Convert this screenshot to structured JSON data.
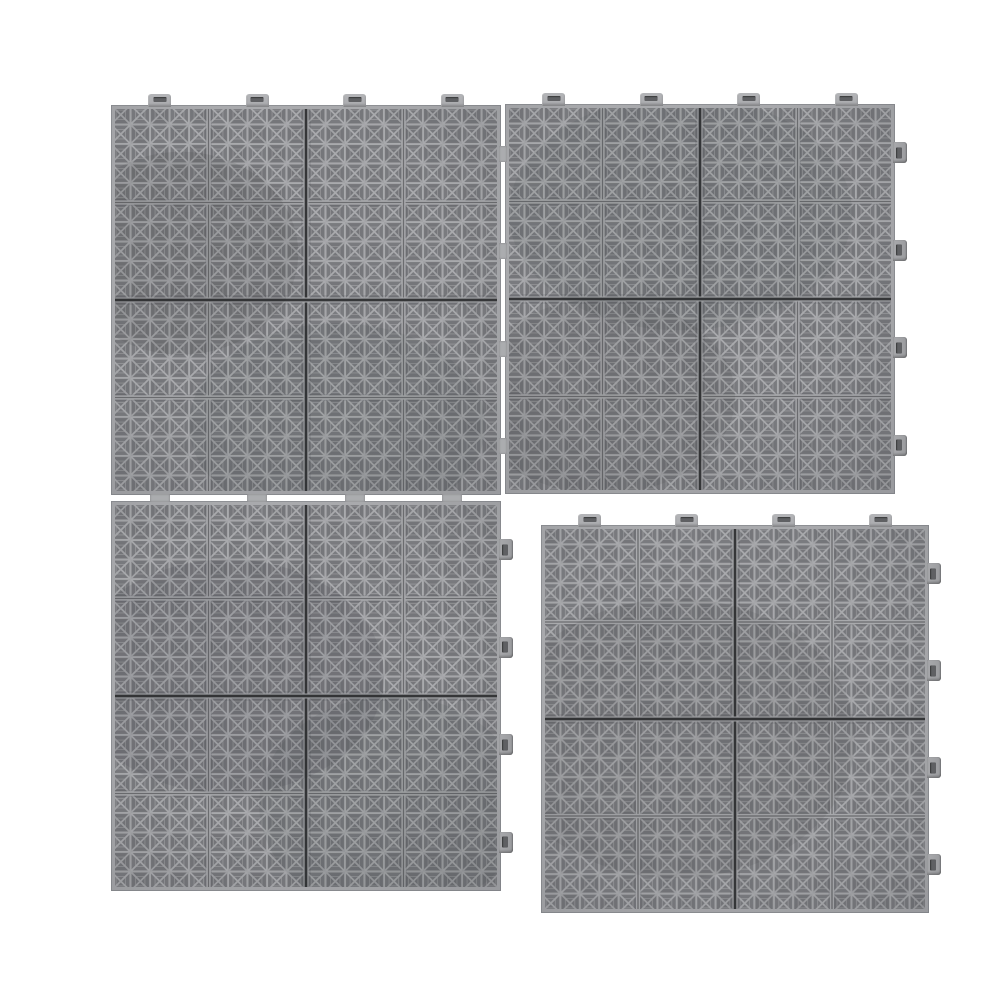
{
  "photo": {
    "subject": "gray-interlocking-perforated-floor-tiles",
    "background": "#ffffff",
    "canvas": {
      "width": 1000,
      "height": 1000
    }
  },
  "palette": {
    "bg": "#ffffff",
    "plastic": "#a9aaad",
    "plastic_rim": "#b4b5b8",
    "tab_side": "#9a9b9e",
    "hole": "#7a7b7f",
    "nested_line": "#97989b",
    "tile_boundary": "#353638",
    "groove": "#6b6c6f",
    "tab_slot": "#5f6063",
    "checker_shade": "rgba(38,40,45,0.055)",
    "shadow_band": "rgba(30,31,35,0.10)",
    "vignette_edge": "rgba(46,48,54,0.13)",
    "seam_bridge": "#abacaf",
    "hairline": "#85868a"
  },
  "pattern": {
    "cells_per_unit": 20,
    "cells_per_quadrant": 5,
    "quadrants_per_tile": 2,
    "tiles_per_unit": 2,
    "tab_top": {
      "w": 23,
      "h": 13
    },
    "tab_right": {
      "w": 14,
      "h": 21
    },
    "quadrant_center_offsets_frac": [
      0.125,
      0.375,
      0.625,
      0.875
    ]
  },
  "units": [
    {
      "id": "unit-top-left",
      "x": 111,
      "y": 105,
      "size": 390,
      "tabs_top": true,
      "tabs_right": false,
      "blotches": [
        {
          "cx": 0.18,
          "cy": 0.38,
          "rx": 0.3,
          "ry": 0.26,
          "o": 0.1
        },
        {
          "cx": 0.58,
          "cy": 0.82,
          "rx": 0.38,
          "ry": 0.26,
          "o": 0.07
        }
      ]
    },
    {
      "id": "unit-top-right",
      "x": 505,
      "y": 104,
      "size": 390,
      "tabs_top": true,
      "tabs_right": true,
      "blotches": [
        {
          "cx": 0.45,
          "cy": 0.28,
          "rx": 0.44,
          "ry": 0.3,
          "o": 0.07
        },
        {
          "cx": 0.25,
          "cy": 0.75,
          "rx": 0.34,
          "ry": 0.25,
          "o": 0.08
        }
      ]
    },
    {
      "id": "unit-bottom-left",
      "x": 111,
      "y": 501,
      "size": 390,
      "tabs_top": false,
      "tabs_right": true,
      "blotches": [
        {
          "cx": 0.3,
          "cy": 0.45,
          "rx": 0.4,
          "ry": 0.3,
          "o": 0.09
        },
        {
          "cx": 0.72,
          "cy": 0.78,
          "rx": 0.34,
          "ry": 0.28,
          "o": 0.07
        }
      ]
    },
    {
      "id": "unit-bottom-right",
      "x": 541,
      "y": 525,
      "size": 388,
      "tabs_top": true,
      "tabs_right": true,
      "blotches": [
        {
          "cx": 0.35,
          "cy": 0.55,
          "rx": 0.46,
          "ry": 0.36,
          "o": 0.08
        }
      ]
    }
  ],
  "seams": [
    {
      "id": "seam-vertical-top",
      "orientation": "vertical",
      "x": 503,
      "from": 105,
      "to": 494,
      "bridge_centers": [
        153.8,
        251.3,
        348.8,
        446.3
      ],
      "bridge_w": 8,
      "bridge_h": 16
    },
    {
      "id": "seam-horizontal-left",
      "orientation": "horizontal",
      "y": 498,
      "from": 111,
      "to": 501,
      "bridge_centers": [
        159.8,
        257.3,
        354.8,
        452.3
      ],
      "bridge_w": 20,
      "bridge_h": 8
    }
  ]
}
